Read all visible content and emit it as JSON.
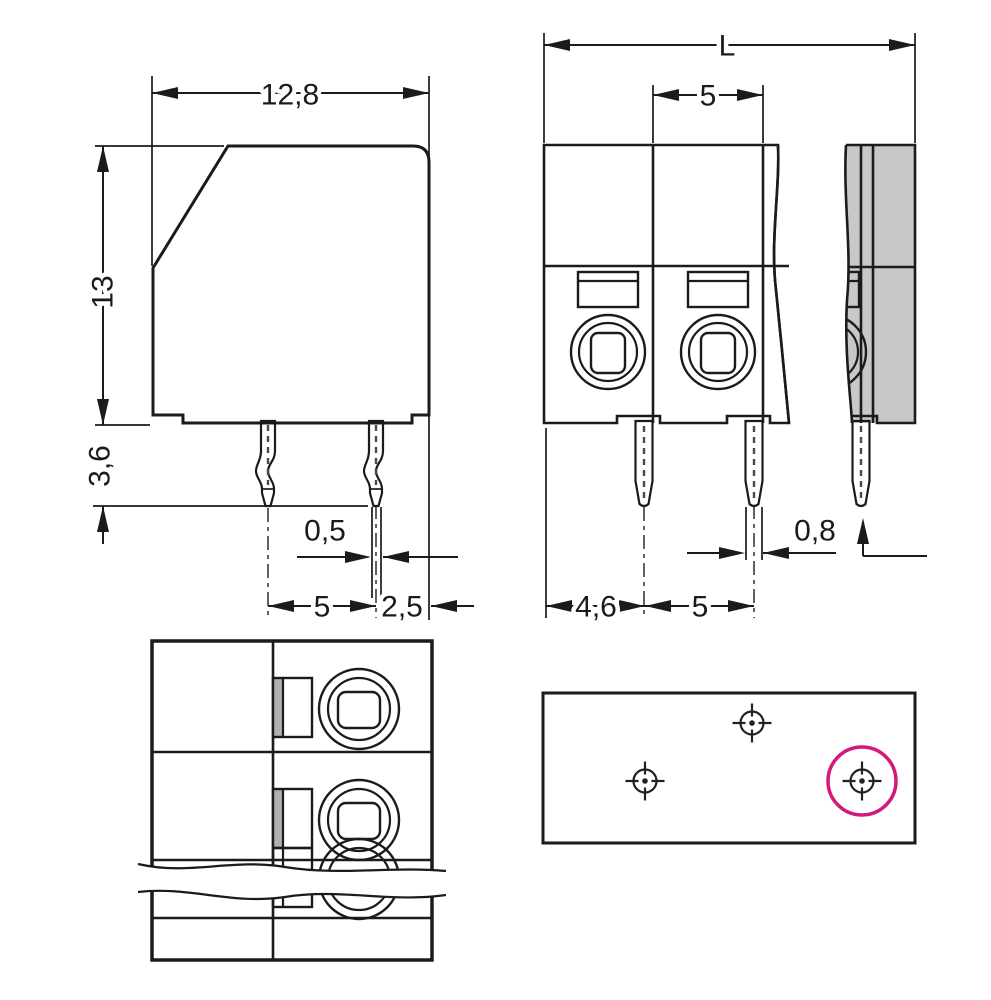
{
  "drawing": {
    "kind": "terminal-block dimensional drawing",
    "views": [
      "side-view",
      "front-view",
      "top-view",
      "drilling-plan"
    ]
  },
  "colors": {
    "body_gray": "#C7C8C9",
    "body_light": "#D2D3D4",
    "recess_gray": "#C2C3C4",
    "slot_shadow": "#AEAFB0",
    "pin_copper": "#F0AF76",
    "button_orange": "#F05B2B",
    "highlight_magenta": "#D4187C",
    "line": "#1B1B1B",
    "plan_bg": "#FFFFFF"
  },
  "side_view": {
    "dims": {
      "width": "12,8",
      "height": "13",
      "pin_length": "3,6",
      "pin_tip_width": "0,5",
      "pin_spacing": "5",
      "pin_edge_offset": "2,5"
    },
    "pin_count": 2
  },
  "front_view": {
    "dims": {
      "total_length": "L",
      "pole_pitch": "5",
      "pin_width": "0,8",
      "first_pin_offset": "4,6",
      "pin_pitch": "5"
    },
    "pole_count_visible": 2,
    "pin_count_visible": 3,
    "has_break_lines": true
  },
  "top_view": {
    "poles_fully_visible": 2,
    "has_break_band": true
  },
  "drilling_plan": {
    "hole_count": 3,
    "highlighted_hole_index": 3
  }
}
